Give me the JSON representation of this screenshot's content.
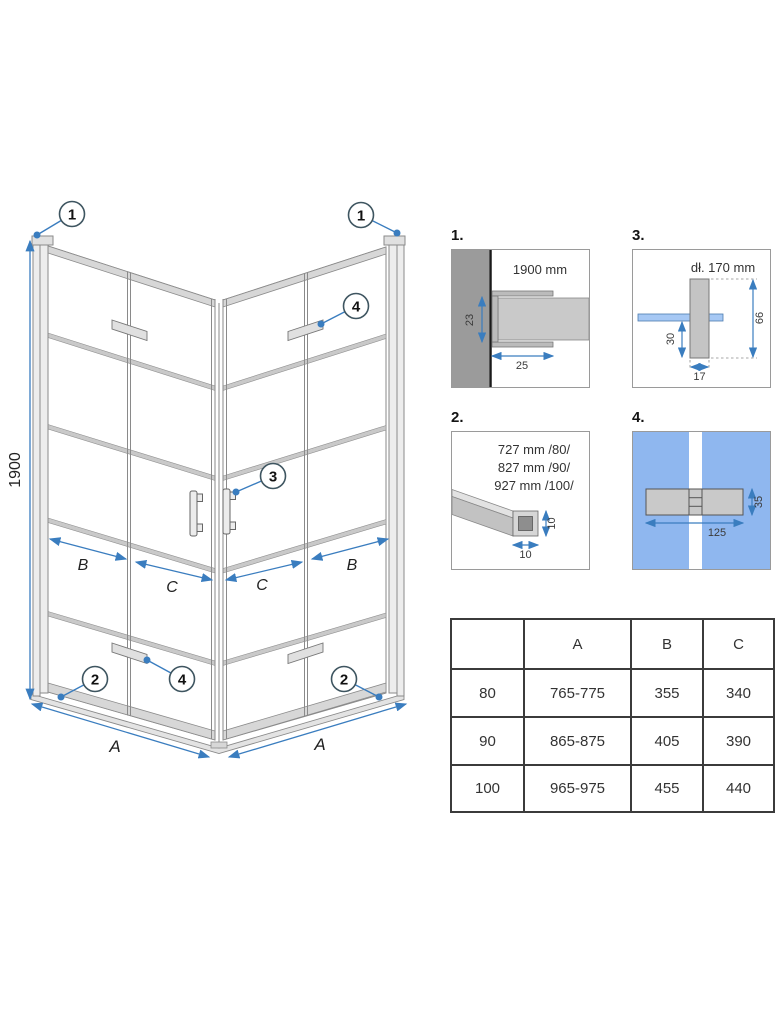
{
  "page": {
    "background": "#ffffff"
  },
  "colors": {
    "accent_blue": "#3a7dbf",
    "callout_stroke": "#3e5560",
    "glass_blue": "#8fb7ef",
    "detail_glass_blue": "#a6c8f4",
    "line_gray": "#8a8a8a",
    "wall_gray": "#9b9b9b",
    "table_border": "#3b3b3b",
    "text_dark": "#333333"
  },
  "main_drawing": {
    "dims": {
      "height": "1900",
      "a_left": "A",
      "a_right": "A",
      "b_left": "B",
      "b_right": "B",
      "c_left": "C",
      "c_right": "C"
    },
    "callouts": {
      "wall_profile_left": "1",
      "wall_profile_right": "1",
      "hinge_top_right": "4",
      "handle": "3",
      "bottom_rail_left": "2",
      "hinge_bottom_left": "4",
      "bottom_rail_right": "2"
    }
  },
  "details": {
    "d1": {
      "label": "1.",
      "caption": "1900 mm",
      "dim_depth": "23",
      "dim_width": "25"
    },
    "d2": {
      "label": "2.",
      "lengths": [
        "727 mm /80/",
        "827 mm /90/",
        "927 mm /100/"
      ],
      "dim_h": "10",
      "dim_w": "10"
    },
    "d3": {
      "label": "3.",
      "caption": "dł. 170 mm",
      "dim_total": "66",
      "dim_lower": "30",
      "dim_width": "17"
    },
    "d4": {
      "label": "4.",
      "dim_length": "125",
      "dim_height": "35"
    }
  },
  "size_table": {
    "headers": [
      "",
      "A",
      "B",
      "C"
    ],
    "rows": [
      [
        "80",
        "765-775",
        "355",
        "340"
      ],
      [
        "90",
        "865-875",
        "405",
        "390"
      ],
      [
        "100",
        "965-975",
        "455",
        "440"
      ]
    ]
  }
}
